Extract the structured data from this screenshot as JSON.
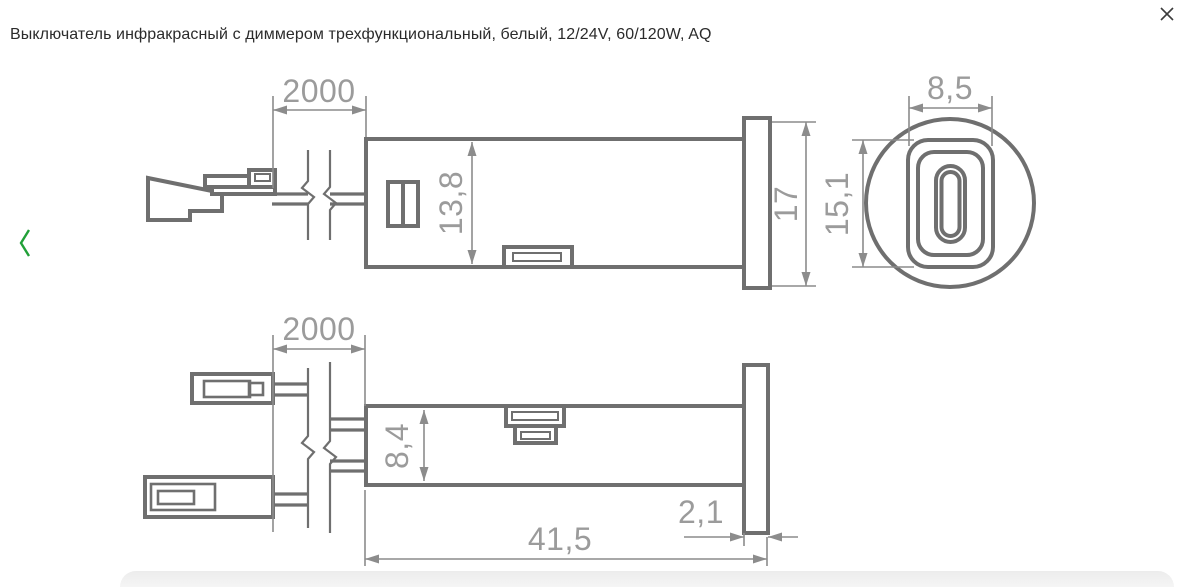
{
  "header": {
    "title": "Выключатель инфракрасный с диммером трехфункциональный, белый, 12/24V, 60/120W, AQ"
  },
  "viewer": {
    "icons": {
      "close": "✕",
      "prev": "‹"
    },
    "colors": {
      "accent_green": "#21A038",
      "line": "#6F6F6F",
      "dim_line": "#8C8C8C",
      "dim_text": "#9B9B9B",
      "title_text": "#2B2B2B",
      "panel": "#F0F0F0"
    }
  },
  "drawing": {
    "side_view": {
      "cable_length": "2000",
      "body_height": "13,8",
      "bezel_diameter": "17"
    },
    "front_view": {
      "window_width": "8,5",
      "window_height": "15,1"
    },
    "top_view": {
      "cable_length": "2000",
      "body_width": "8,4",
      "total_length": "41,5",
      "bezel_thickness": "2,1"
    }
  }
}
